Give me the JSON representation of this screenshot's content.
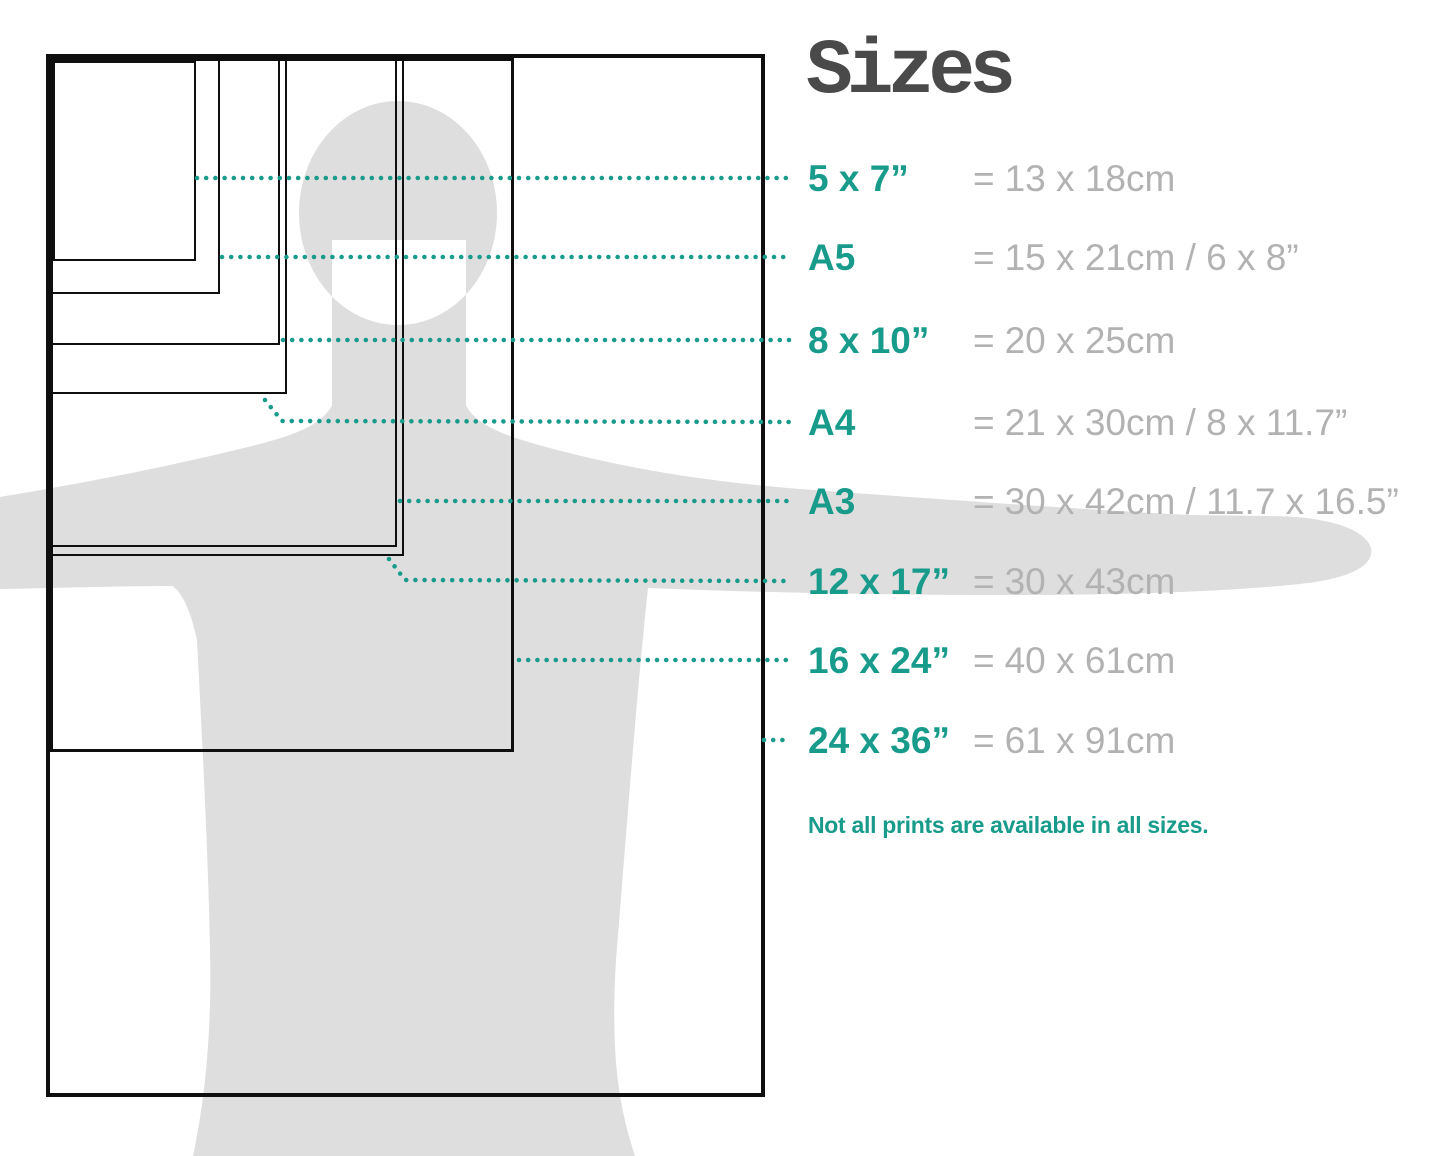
{
  "title": "Sizes",
  "equals": "=",
  "sizes": [
    {
      "label": "5 x 7”",
      "metric": "13 x 18cm"
    },
    {
      "label": "A5",
      "metric": "15 x 21cm / 6 x 8”"
    },
    {
      "label": "8 x 10”",
      "metric": "20 x 25cm"
    },
    {
      "label": "A4",
      "metric": "21 x 30cm / 8 x 11.7”"
    },
    {
      "label": "A3",
      "metric": "30 x 42cm / 11.7 x 16.5”"
    },
    {
      "label": "12 x 17”",
      "metric": "30 x 43cm"
    },
    {
      "label": "16 x 24”",
      "metric": "40 x 61cm"
    },
    {
      "label": "24 x 36”",
      "metric": "61 x 91cm"
    }
  ],
  "note": "Not all prints are available in all sizes.",
  "colors": {
    "accent": "#189b8b",
    "muted": "#b2b2b2",
    "title": "#4a4a4a",
    "silhouette": "#dedede",
    "outline": "#0f0f0f"
  }
}
